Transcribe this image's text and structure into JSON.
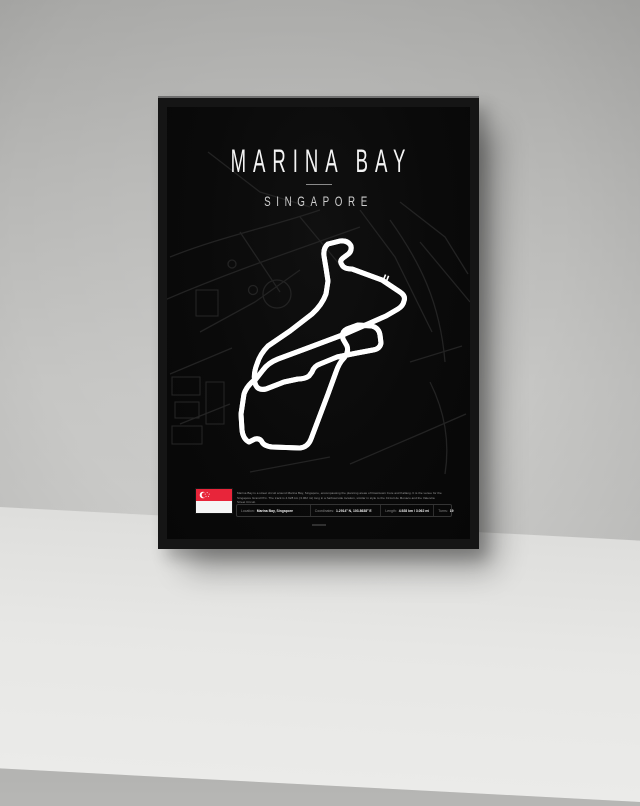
{
  "poster": {
    "title": "MARINA BAY",
    "subtitle": "SINGAPORE",
    "description": "Marina Bay is a street circuit around Marina Bay, Singapore, encompassing the planning areas of Downtown Core and Kallang. It is the venue for the Singapore Grand Prix. The track is 4.928 km (3.062 mi) long in a harbourside location, similar in style to the Circuit de Monaco and the Valencia Street Circuit.",
    "stats": [
      {
        "label": "Location:",
        "value": "Marina Bay, Singapore"
      },
      {
        "label": "Coordinates:",
        "value": "1.2914° N, 103.8638° E"
      },
      {
        "label": "Length:",
        "value": "4.928 km / 3.062 mi"
      },
      {
        "label": "Turns:",
        "value": "19"
      }
    ],
    "flag": "singapore-flag",
    "colors": {
      "poster_background": "#0a0a0a",
      "track_line": "#ffffff",
      "background_streets": "#242424",
      "flag_red": "#e8253a",
      "frame": "#151515",
      "wall": "#bdbdbb",
      "floor": "#e4e4e2"
    }
  }
}
